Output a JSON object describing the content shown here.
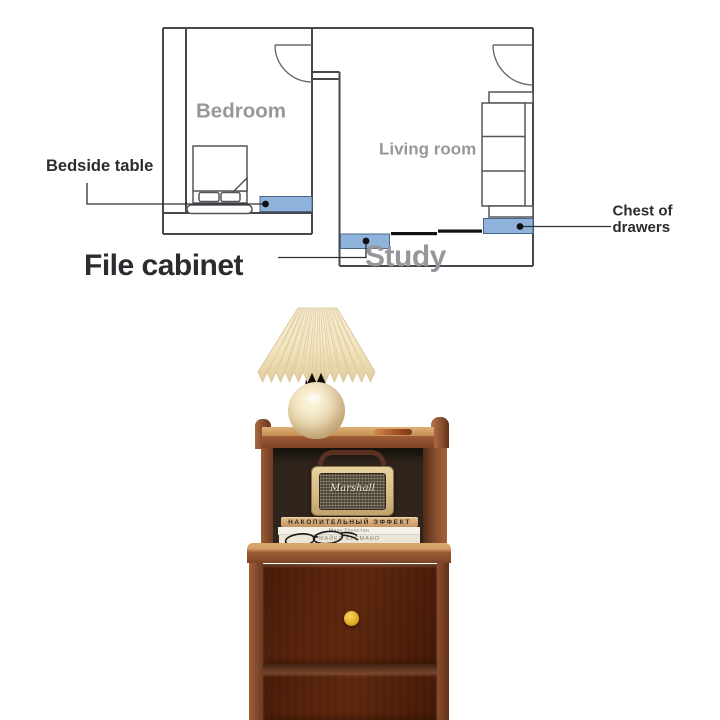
{
  "page": {
    "background": "#ffffff"
  },
  "floor_plan": {
    "line_color": "#47484d",
    "highlight_color": "#8fb3da",
    "rooms": {
      "bedroom": "Bedroom",
      "living_room": "Living room",
      "study": "Study"
    },
    "callouts": {
      "bedside_table": "Bedside table",
      "file_cabinet": "File cabinet",
      "chest_line1": "Chest of",
      "chest_line2": "drawers"
    }
  },
  "photo": {
    "speaker_logo": "Marshall",
    "books": {
      "top_title": "НАКОПИТЕЛЬНЫЙ ЭФФЕКТ",
      "middle_author": "Марк Гоулстон",
      "bottom_author": "МАЙКЛ ХУСМАНО"
    },
    "knob_color": "#e3aa24",
    "wood_color": "#96603a"
  }
}
